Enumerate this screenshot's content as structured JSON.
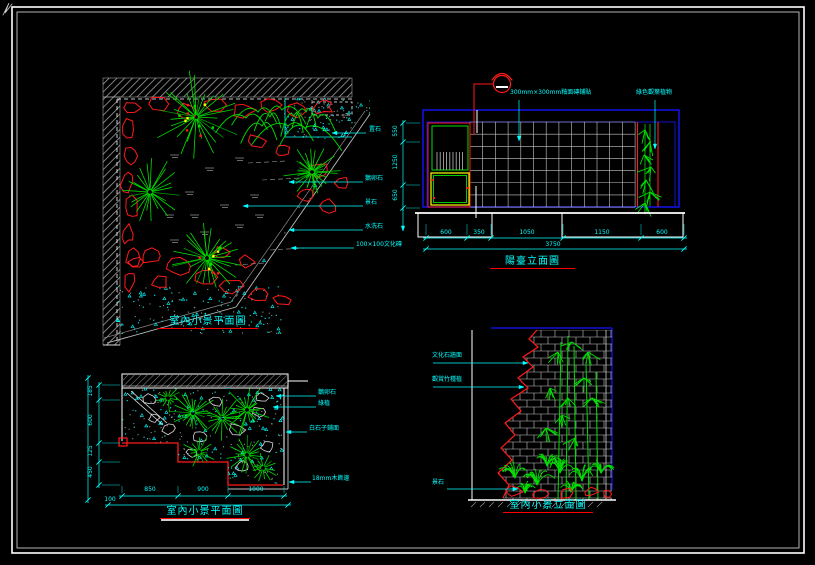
{
  "palette": {
    "background": "#000000",
    "border_white": "#ffffff",
    "rock_red": "#ff1a1a",
    "plant_green": "#00e000",
    "dim_cyan": "#00ffff",
    "frame_blue": "#1414ff",
    "hatch_gray": "#a8a8a8",
    "accent_yellow": "#ffff00"
  },
  "tl": {
    "title": "室內小景平面圖",
    "labels": [
      "置石",
      "鵝卵石",
      "景石",
      "水洗石",
      "100×100文化磚"
    ]
  },
  "tr": {
    "title": "陽臺立面圖",
    "tile_label": "300mm×300mm釉面磚鋪貼",
    "plant_label": "綠色觀葉植物",
    "dims_bottom": [
      "600",
      "350",
      "1050",
      "1150",
      "600"
    ],
    "dims_total": "3750",
    "dims_left": [
      "550",
      "1250",
      "650"
    ]
  },
  "bl": {
    "title": "室內小景平面圖",
    "labels": [
      "鵝卵石",
      "綠植",
      "白石子鋪面",
      "18mm木飾邊"
    ],
    "dims_bottom": [
      "850",
      "900",
      "1000"
    ],
    "dims_left": [
      "185",
      "600",
      "125",
      "450"
    ],
    "dim_note": "100"
  },
  "br": {
    "title": "室內小景立面圖",
    "labels": [
      "文化石牆面",
      "觀賞竹種植",
      "景石"
    ]
  }
}
